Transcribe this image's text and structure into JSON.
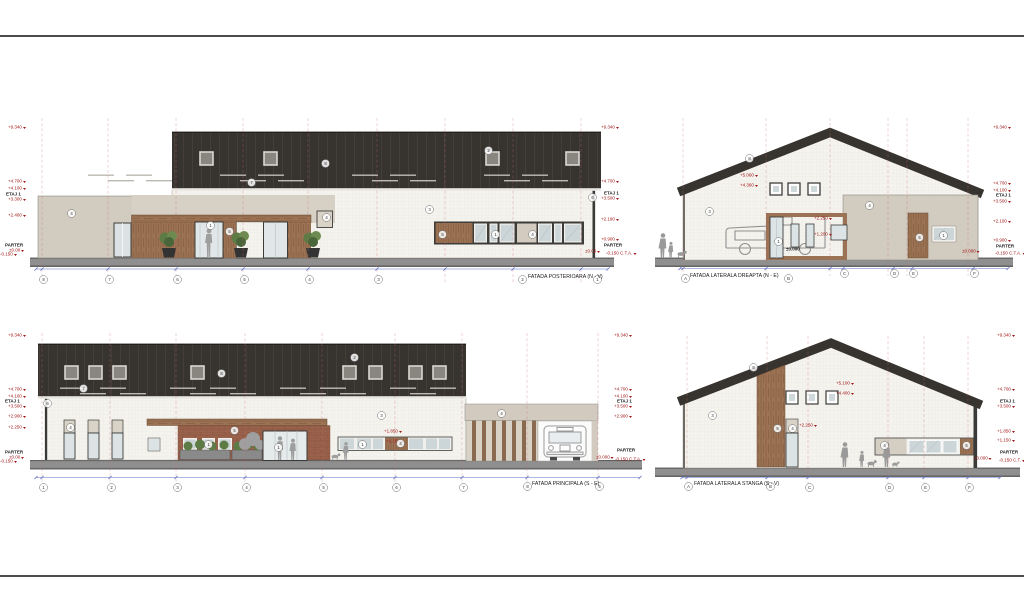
{
  "palette": {
    "roof": "#37332e",
    "wall": "#f5f3ee",
    "annex_beige": "#d2cbbf",
    "wood": "#9b7254",
    "brick": "#9a614b",
    "ground": "#8f8f8f",
    "marker_red": "#a01717",
    "dim_blue": "#5b6cc0",
    "grid_red": "#c96f6f",
    "glass": "#ccd5d7"
  },
  "captions": [
    {
      "text": "FATADA POSTERIOARA (N - V)",
      "style": {
        "left": "528px",
        "top": "274px"
      }
    },
    {
      "text": "FATADA LATERALA DREAPTA (N - E)",
      "style": {
        "left": "690px",
        "top": "273px"
      }
    },
    {
      "text": "FATADA PRINCIPALA (S - E)",
      "style": {
        "left": "532px",
        "top": "481px"
      }
    },
    {
      "text": "FATADA LATERALA STANGA (S - V)",
      "style": {
        "left": "694px",
        "top": "481px"
      }
    }
  ],
  "levels": [
    {
      "text": "+9.340",
      "style": {
        "left": "8px",
        "top": "125px"
      }
    },
    {
      "text": "+4.700",
      "style": {
        "left": "8px",
        "top": "179px"
      }
    },
    {
      "text": "+4.100",
      "style": {
        "left": "8px",
        "top": "186px"
      }
    },
    {
      "text": "ETAJ 1",
      "cls": "blk",
      "style": {
        "left": "6px",
        "top": "192px"
      }
    },
    {
      "text": "+3.300",
      "style": {
        "left": "8px",
        "top": "197px"
      }
    },
    {
      "text": "+2.400",
      "style": {
        "left": "8px",
        "top": "213px"
      }
    },
    {
      "text": "PARTER",
      "cls": "blk",
      "style": {
        "left": "5px",
        "top": "243px"
      }
    },
    {
      "text": "±0.00",
      "style": {
        "left": "9px",
        "top": "248px"
      }
    },
    {
      "text": "-0.150",
      "style": {
        "left": "0px",
        "top": "252px"
      }
    },
    {
      "text": "+9.340",
      "style": {
        "left": "601px",
        "top": "125px"
      }
    },
    {
      "text": "+4.700",
      "style": {
        "left": "601px",
        "top": "179px"
      }
    },
    {
      "text": "ETAJ 1",
      "cls": "blk",
      "style": {
        "left": "604px",
        "top": "191px"
      }
    },
    {
      "text": "+3.500",
      "style": {
        "left": "601px",
        "top": "196px"
      }
    },
    {
      "text": "+2.190",
      "style": {
        "left": "601px",
        "top": "217px"
      }
    },
    {
      "text": "+0.900",
      "style": {
        "left": "601px",
        "top": "237px"
      }
    },
    {
      "text": "PARTER",
      "cls": "blk",
      "style": {
        "left": "604px",
        "top": "243px"
      }
    },
    {
      "text": "±0.00",
      "style": {
        "left": "585px",
        "top": "249px"
      }
    },
    {
      "text": "-0.150 C.T.A.",
      "style": {
        "left": "606px",
        "top": "251px"
      }
    },
    {
      "text": "+9.340",
      "style": {
        "left": "993px",
        "top": "125px"
      }
    },
    {
      "text": "+4.700",
      "style": {
        "left": "993px",
        "top": "181px"
      }
    },
    {
      "text": "+4.100",
      "style": {
        "left": "993px",
        "top": "188px"
      }
    },
    {
      "text": "ETAJ 1",
      "cls": "blk",
      "style": {
        "left": "996px",
        "top": "193px"
      }
    },
    {
      "text": "+3.500",
      "style": {
        "left": "993px",
        "top": "199px"
      }
    },
    {
      "text": "+2.100",
      "style": {
        "left": "993px",
        "top": "219px"
      }
    },
    {
      "text": "+0.900",
      "style": {
        "left": "993px",
        "top": "238px"
      }
    },
    {
      "text": "PARTER",
      "cls": "blk",
      "style": {
        "left": "996px",
        "top": "244px"
      }
    },
    {
      "text": "±0.000",
      "style": {
        "left": "962px",
        "top": "249px"
      }
    },
    {
      "text": "-0.150 C.T.A.",
      "style": {
        "left": "995px",
        "top": "251px"
      }
    },
    {
      "text": "+5.060",
      "style": {
        "left": "740px",
        "top": "173px"
      }
    },
    {
      "text": "+4.360",
      "style": {
        "left": "740px",
        "top": "183px"
      }
    },
    {
      "text": "+2.250",
      "style": {
        "left": "814px",
        "top": "216px"
      }
    },
    {
      "text": "+1.200",
      "style": {
        "left": "814px",
        "top": "232px"
      }
    },
    {
      "text": "±0.000",
      "cls": "blk",
      "style": {
        "left": "786px",
        "top": "247px"
      }
    },
    {
      "text": "+9.340",
      "style": {
        "left": "8px",
        "top": "333px"
      }
    },
    {
      "text": "+4.700",
      "style": {
        "left": "8px",
        "top": "387px"
      }
    },
    {
      "text": "+4.100",
      "style": {
        "left": "8px",
        "top": "394px"
      }
    },
    {
      "text": "ETAJ 1",
      "cls": "blk",
      "style": {
        "left": "5px",
        "top": "399px"
      }
    },
    {
      "text": "+3.500",
      "style": {
        "left": "8px",
        "top": "404px"
      }
    },
    {
      "text": "+2.900",
      "style": {
        "left": "8px",
        "top": "414px"
      }
    },
    {
      "text": "+2.250",
      "style": {
        "left": "8px",
        "top": "425px"
      }
    },
    {
      "text": "PARTER",
      "cls": "blk",
      "style": {
        "left": "5px",
        "top": "450px"
      }
    },
    {
      "text": "±0.00",
      "style": {
        "left": "9px",
        "top": "455px"
      }
    },
    {
      "text": "-0.150",
      "style": {
        "left": "0px",
        "top": "459px"
      }
    },
    {
      "text": "+9.340",
      "style": {
        "left": "614px",
        "top": "333px"
      }
    },
    {
      "text": "+4.700",
      "style": {
        "left": "614px",
        "top": "387px"
      }
    },
    {
      "text": "+4.100",
      "style": {
        "left": "614px",
        "top": "394px"
      }
    },
    {
      "text": "ETAJ 1",
      "cls": "blk",
      "style": {
        "left": "617px",
        "top": "399px"
      }
    },
    {
      "text": "+3.500",
      "style": {
        "left": "614px",
        "top": "404px"
      }
    },
    {
      "text": "+2.900",
      "style": {
        "left": "614px",
        "top": "414px"
      }
    },
    {
      "text": "PARTER",
      "cls": "blk",
      "style": {
        "left": "617px",
        "top": "448px"
      }
    },
    {
      "text": "±0.000",
      "style": {
        "left": "596px",
        "top": "455px"
      }
    },
    {
      "text": "-0.150 C.T.A.",
      "style": {
        "left": "615px",
        "top": "457px"
      }
    },
    {
      "text": "+1.850",
      "style": {
        "left": "384px",
        "top": "429px"
      }
    },
    {
      "text": "+1.150",
      "style": {
        "left": "386px",
        "top": "439px"
      }
    },
    {
      "text": "+9.340",
      "style": {
        "left": "997px",
        "top": "333px"
      }
    },
    {
      "text": "+4.700",
      "style": {
        "left": "997px",
        "top": "387px"
      }
    },
    {
      "text": "ETAJ 1",
      "cls": "blk",
      "style": {
        "left": "1000px",
        "top": "399px"
      }
    },
    {
      "text": "+3.500",
      "style": {
        "left": "997px",
        "top": "404px"
      }
    },
    {
      "text": "+1.850",
      "style": {
        "left": "997px",
        "top": "429px"
      }
    },
    {
      "text": "+1.150",
      "style": {
        "left": "997px",
        "top": "438px"
      }
    },
    {
      "text": "PARTER",
      "cls": "blk",
      "style": {
        "left": "1000px",
        "top": "450px"
      }
    },
    {
      "text": "±0.000",
      "style": {
        "left": "974px",
        "top": "456px"
      }
    },
    {
      "text": "-0.150 C.T.",
      "style": {
        "left": "999px",
        "top": "458px"
      }
    },
    {
      "text": "+5.100",
      "style": {
        "left": "836px",
        "top": "381px"
      }
    },
    {
      "text": "+4.400",
      "style": {
        "left": "836px",
        "top": "391px"
      }
    },
    {
      "text": "+2.250",
      "style": {
        "left": "799px",
        "top": "423px"
      }
    }
  ],
  "bubbles": [
    {
      "text": "8",
      "style": {
        "left": "42px",
        "top": "278px"
      }
    },
    {
      "text": "7",
      "style": {
        "left": "108px",
        "top": "278px"
      }
    },
    {
      "text": "6",
      "style": {
        "left": "176px",
        "top": "278px"
      }
    },
    {
      "text": "5",
      "style": {
        "left": "243px",
        "top": "278px"
      }
    },
    {
      "text": "4",
      "style": {
        "left": "308px",
        "top": "278px"
      }
    },
    {
      "text": "3",
      "style": {
        "left": "377px",
        "top": "278px"
      }
    },
    {
      "text": "2",
      "style": {
        "left": "521px",
        "top": "278px"
      }
    },
    {
      "text": "1",
      "style": {
        "left": "596px",
        "top": "278px"
      }
    },
    {
      "text": "4",
      "style": {
        "left": "70px",
        "top": "212px"
      }
    },
    {
      "text": "3",
      "style": {
        "left": "428px",
        "top": "208px"
      }
    },
    {
      "text": "8",
      "style": {
        "left": "324px",
        "top": "162px"
      }
    },
    {
      "text": "7",
      "style": {
        "left": "250px",
        "top": "181px"
      }
    },
    {
      "text": "2",
      "style": {
        "left": "487px",
        "top": "149px"
      }
    },
    {
      "text": "5",
      "style": {
        "left": "228px",
        "top": "230px"
      }
    },
    {
      "text": "1",
      "style": {
        "left": "209px",
        "top": "224px"
      }
    },
    {
      "text": "5",
      "style": {
        "left": "441px",
        "top": "233px"
      }
    },
    {
      "text": "1",
      "style": {
        "left": "494px",
        "top": "233px"
      }
    },
    {
      "text": "4",
      "style": {
        "left": "531px",
        "top": "233px"
      }
    },
    {
      "text": "4",
      "style": {
        "left": "325px",
        "top": "216px"
      }
    },
    {
      "text": "6",
      "style": {
        "left": "591px",
        "top": "196px"
      }
    },
    {
      "text": "C",
      "style": {
        "left": "843px",
        "top": "272px"
      }
    },
    {
      "text": "D",
      "style": {
        "left": "893px",
        "top": "272px"
      }
    },
    {
      "text": "E",
      "style": {
        "left": "912px",
        "top": "272px"
      }
    },
    {
      "text": "F",
      "style": {
        "left": "973px",
        "top": "272px"
      }
    },
    {
      "text": "A",
      "style": {
        "left": "684px",
        "top": "277px"
      }
    },
    {
      "text": "B",
      "style": {
        "left": "787px",
        "top": "277px"
      }
    },
    {
      "text": "8",
      "style": {
        "left": "748px",
        "top": "157px"
      }
    },
    {
      "text": "3",
      "style": {
        "left": "708px",
        "top": "210px"
      }
    },
    {
      "text": "4",
      "style": {
        "left": "868px",
        "top": "204px"
      }
    },
    {
      "text": "1",
      "style": {
        "left": "777px",
        "top": "240px"
      }
    },
    {
      "text": "5",
      "style": {
        "left": "918px",
        "top": "236px"
      }
    },
    {
      "text": "1",
      "style": {
        "left": "942px",
        "top": "234px"
      }
    },
    {
      "text": "1",
      "style": {
        "left": "42px",
        "top": "486px"
      }
    },
    {
      "text": "2",
      "style": {
        "left": "110px",
        "top": "486px"
      }
    },
    {
      "text": "3",
      "style": {
        "left": "176px",
        "top": "486px"
      }
    },
    {
      "text": "4",
      "style": {
        "left": "245px",
        "top": "486px"
      }
    },
    {
      "text": "5",
      "style": {
        "left": "322px",
        "top": "486px"
      }
    },
    {
      "text": "6",
      "style": {
        "left": "395px",
        "top": "486px"
      }
    },
    {
      "text": "7",
      "style": {
        "left": "462px",
        "top": "486px"
      }
    },
    {
      "text": "8",
      "style": {
        "left": "526px",
        "top": "485px"
      }
    },
    {
      "text": "5",
      "style": {
        "left": "598px",
        "top": "485px"
      }
    },
    {
      "text": "2",
      "style": {
        "left": "353px",
        "top": "356px"
      }
    },
    {
      "text": "8",
      "style": {
        "left": "220px",
        "top": "372px"
      }
    },
    {
      "text": "7",
      "style": {
        "left": "82px",
        "top": "387px"
      }
    },
    {
      "text": "6",
      "style": {
        "left": "46px",
        "top": "402px"
      }
    },
    {
      "text": "3",
      "style": {
        "left": "380px",
        "top": "414px"
      }
    },
    {
      "text": "5",
      "style": {
        "left": "233px",
        "top": "429px"
      }
    },
    {
      "text": "1",
      "style": {
        "left": "277px",
        "top": "446px"
      }
    },
    {
      "text": "1",
      "style": {
        "left": "207px",
        "top": "443px"
      }
    },
    {
      "text": "1",
      "style": {
        "left": "361px",
        "top": "443px"
      }
    },
    {
      "text": "4",
      "style": {
        "left": "399px",
        "top": "442px"
      }
    },
    {
      "text": "4",
      "style": {
        "left": "500px",
        "top": "412px"
      }
    },
    {
      "text": "4",
      "style": {
        "left": "69px",
        "top": "426px"
      }
    },
    {
      "text": "C",
      "style": {
        "left": "808px",
        "top": "486px"
      }
    },
    {
      "text": "D",
      "style": {
        "left": "888px",
        "top": "486px"
      }
    },
    {
      "text": "E",
      "style": {
        "left": "924px",
        "top": "486px"
      }
    },
    {
      "text": "F",
      "style": {
        "left": "968px",
        "top": "486px"
      }
    },
    {
      "text": "A",
      "style": {
        "left": "687px",
        "top": "485px"
      }
    },
    {
      "text": "B",
      "style": {
        "left": "769px",
        "top": "485px"
      }
    },
    {
      "text": "8",
      "style": {
        "left": "752px",
        "top": "366px"
      }
    },
    {
      "text": "3",
      "style": {
        "left": "711px",
        "top": "414px"
      }
    },
    {
      "text": "5",
      "style": {
        "left": "776px",
        "top": "427px"
      }
    },
    {
      "text": "4",
      "style": {
        "left": "791px",
        "top": "427px"
      }
    },
    {
      "text": "4",
      "style": {
        "left": "883px",
        "top": "444px"
      }
    },
    {
      "text": "5",
      "style": {
        "left": "965px",
        "top": "444px"
      }
    }
  ]
}
